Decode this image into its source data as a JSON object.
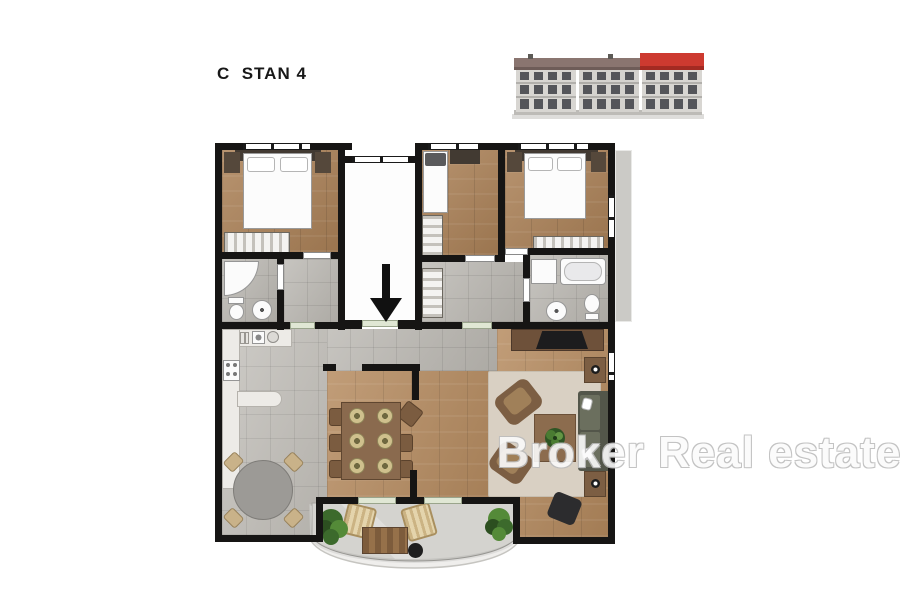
{
  "title": "C  STAN 4",
  "watermark": "Broker Real estate",
  "building": {
    "floors": 3,
    "sections": 3,
    "highlighted_section": "right",
    "highlight_roof_color": "#cd3a30",
    "roof_color": "#8a7570",
    "facade_color": "#d8d6d2"
  },
  "plan": {
    "entrance_arrow_direction": "down",
    "rooms": [
      "bedroom-1",
      "bedroom-2",
      "bedroom-3",
      "bathroom-1",
      "bathroom-2",
      "hallway",
      "kitchen",
      "dining-area",
      "living-room",
      "terrace",
      "stairwell"
    ],
    "colors": {
      "wall": "#161514",
      "wood_floor": "#ac8258",
      "tile_floor": "#b7b4ae",
      "terrace_floor": "#d4d3cf",
      "door_sill": "#e0e7d4"
    }
  }
}
